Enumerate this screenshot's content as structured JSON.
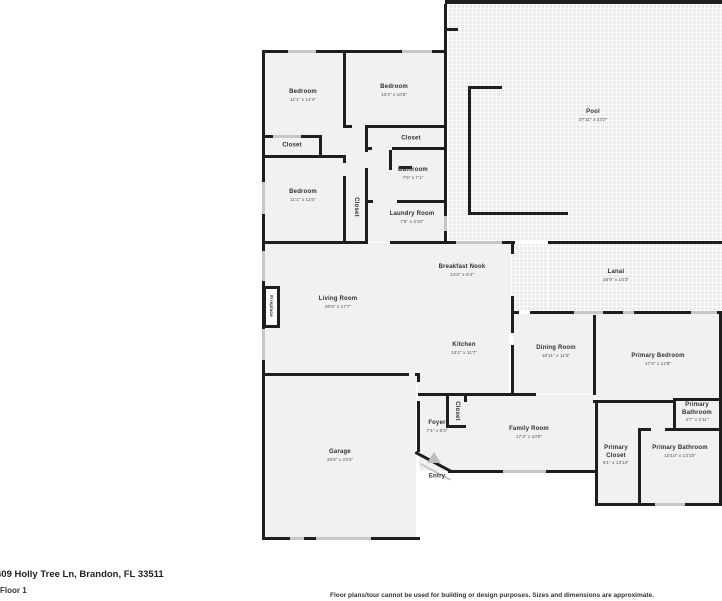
{
  "meta": {
    "address": "409 Holly Tree Ln, Brandon, FL 33511",
    "floor_label": "Floor 1",
    "disclaimer": "Floor plans/tour cannot be used for building or design purposes. Sizes and dimensions are approximate."
  },
  "colors": {
    "wall": "#1e1e1e",
    "floor": "#f1f1f1",
    "deck": "#ebebeb",
    "window": "#c7c7c7",
    "nametext": "#2f2f2f",
    "dimstext": "#585858",
    "entryicon": "#bdbdbd"
  },
  "rooms": [
    {
      "id": "bedroom-1",
      "name": "Bedroom",
      "dims": "11'1\" x 14'4\"",
      "cx": 303,
      "cy": 96
    },
    {
      "id": "bedroom-2",
      "name": "Bedroom",
      "dims": "13'4\" x 10'8\"",
      "cx": 394,
      "cy": 91
    },
    {
      "id": "closet-bedroom-1",
      "name": "Closet",
      "dims": "",
      "cx": 292,
      "cy": 146
    },
    {
      "id": "bedroom-3",
      "name": "Bedroom",
      "dims": "11'1\" x 11'5\"",
      "cx": 303,
      "cy": 196
    },
    {
      "id": "closet-bedroom-3",
      "name": "Closet",
      "dims": "",
      "cx": 355,
      "cy": 207,
      "rot": true
    },
    {
      "id": "closet-hall",
      "name": "Closet",
      "dims": "",
      "cx": 411,
      "cy": 139
    },
    {
      "id": "bathroom",
      "name": "Bathroom",
      "dims": "7'5\" x 7'1\"",
      "cx": 413,
      "cy": 174
    },
    {
      "id": "laundry-room",
      "name": "Laundry Room",
      "dims": "7'5\" x 4'10\"",
      "cx": 412,
      "cy": 218
    },
    {
      "id": "pool",
      "name": "Pool",
      "dims": "37'11\" x 23'2\"",
      "cx": 593,
      "cy": 116
    },
    {
      "id": "lanai",
      "name": "Lanai",
      "dims": "28'9\" x 10'3\"",
      "cx": 616,
      "cy": 276
    },
    {
      "id": "breakfast-nook",
      "name": "Breakfast Nook",
      "dims": "13'2\" x 9'4\"",
      "cx": 462,
      "cy": 271
    },
    {
      "id": "living-room",
      "name": "Living Room",
      "dims": "20'6\" x 17'7\"",
      "cx": 338,
      "cy": 303
    },
    {
      "id": "fireplace",
      "name": "Fireplace",
      "dims": "",
      "cx": 271,
      "cy": 306,
      "rot": true,
      "small": true
    },
    {
      "id": "kitchen",
      "name": "Kitchen",
      "dims": "13'2\" x 11'7\"",
      "cx": 464,
      "cy": 349
    },
    {
      "id": "dining-room",
      "name": "Dining Room",
      "dims": "10'11\" x 11'5\"",
      "cx": 556,
      "cy": 352
    },
    {
      "id": "primary-bedroom",
      "name": "Primary Bedroom",
      "dims": "17'4\" x 12'8\"",
      "cx": 658,
      "cy": 360
    },
    {
      "id": "foyer",
      "name": "Foyer",
      "dims": "7'1\" x 9'3\"",
      "cx": 437,
      "cy": 427
    },
    {
      "id": "closet-foyer",
      "name": "Closet",
      "dims": "",
      "cx": 456,
      "cy": 411,
      "rot": true
    },
    {
      "id": "family-room",
      "name": "Family Room",
      "dims": "17'3\" x 10'9\"",
      "cx": 529,
      "cy": 433
    },
    {
      "id": "entry",
      "name": "Entry",
      "dims": "",
      "cx": 437,
      "cy": 477
    },
    {
      "id": "garage",
      "name": "Garage",
      "dims": "20'6\" x 23'4\"",
      "cx": 340,
      "cy": 456
    },
    {
      "id": "primary-closet",
      "name": "Primary Closet",
      "dims": "6'1\" x 13'10\"",
      "cx": 616,
      "cy": 456,
      "w": 36
    },
    {
      "id": "primary-bathroom",
      "name": "Primary Bathroom",
      "dims": "10'10\" x 13'10\"",
      "cx": 680,
      "cy": 452,
      "w": 60
    },
    {
      "id": "primary-bathroom-2",
      "name": "Primary Bathroom",
      "dims": "4'7\" x 2'11\"",
      "cx": 697,
      "cy": 413,
      "w": 40
    }
  ]
}
